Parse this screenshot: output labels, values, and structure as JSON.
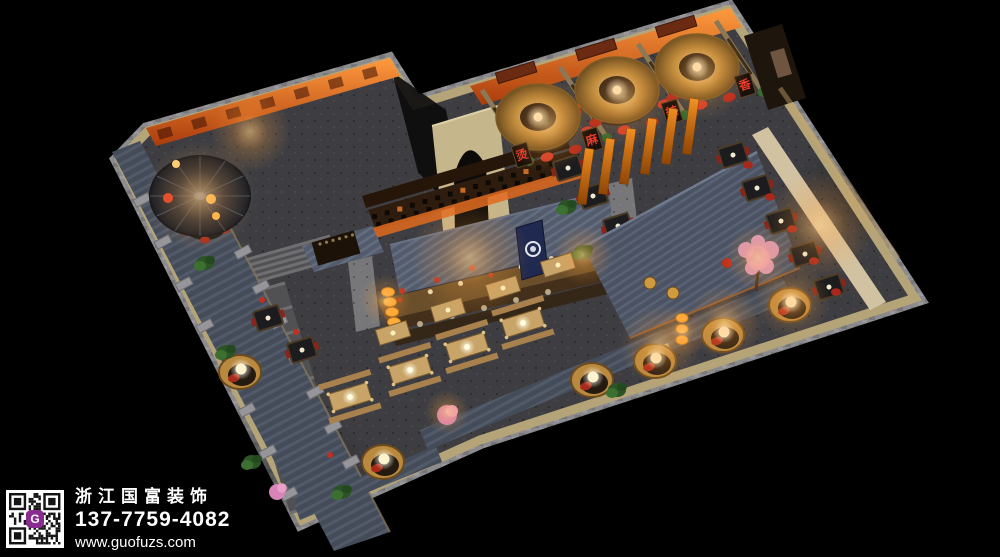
{
  "watermark": {
    "company_name": "浙江国富装饰",
    "phone": "137-7759-4082",
    "website": "www.guofuzs.com",
    "qr_badge_letter": "G",
    "colors": {
      "text": "#ffffff",
      "qr_bg": "#ffffff",
      "qr_fg": "#141414",
      "badge": "#8a2b8f"
    }
  },
  "signage": {
    "booth_plaques": [
      {
        "char": "烫"
      },
      {
        "char": "麻"
      },
      {
        "char": "辣"
      },
      {
        "char": "香"
      }
    ],
    "plaque_text_color": "#e8392a",
    "entrance_banner_color": "#20294f",
    "entrance_banner_emblem": "round-seal-icon"
  },
  "palette": {
    "background": "#000000",
    "floor": "#3e3e42",
    "wall_tan": "#b5a478",
    "stone": "#8b8b8e",
    "roof_slate": "#4b5363",
    "orange_glow_wall": "#ff9a3e",
    "banner_orange": "#ef8c20",
    "lantern": "#ffad3a",
    "chair_red": "#b52a1c",
    "brass_lamp": "#b98a3e",
    "wood_table": "#c9a468",
    "plant_green": "#2c5426",
    "blossom_pink": "#e8a0c8",
    "pod_rattan": "#b9893f"
  }
}
